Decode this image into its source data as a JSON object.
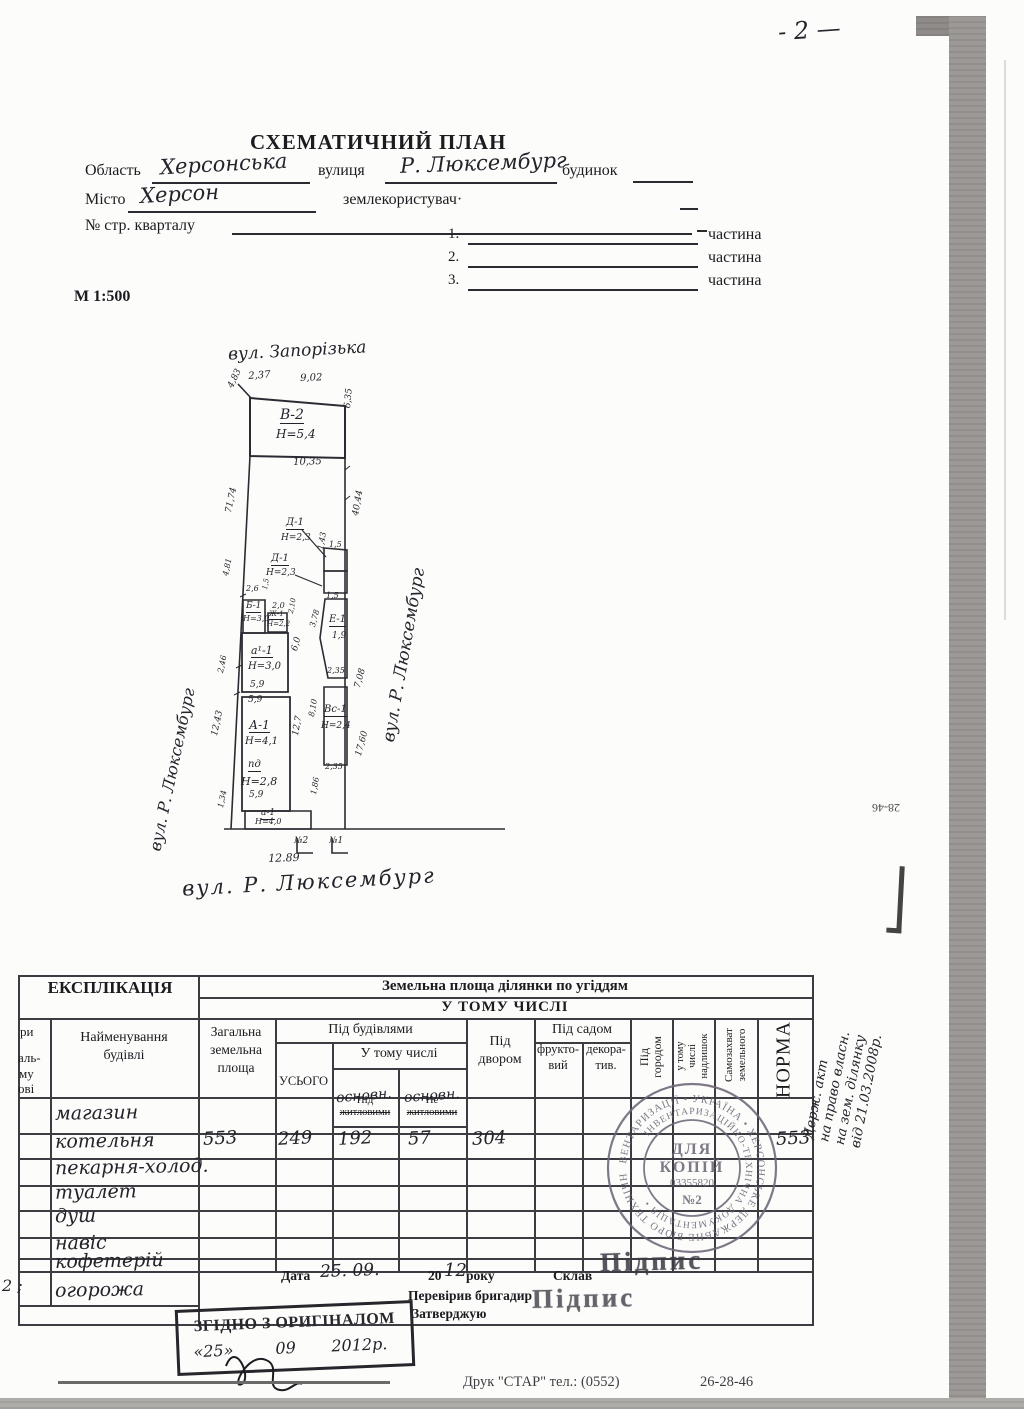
{
  "page": {
    "number": "- 2 —",
    "scale": "М 1:500",
    "footer_print": "Друк \"СТАР\" тел.: (0552)",
    "footer_phone": "26-28-46",
    "edge_note": "28-46"
  },
  "header": {
    "title": "СХЕМАТИЧНИЙ ПЛАН"
  },
  "form": {
    "oblast_label": "Область",
    "oblast_value": "Херсонська",
    "street_label": "вулиця",
    "street_value": "Р. Люксембург",
    "budynok_label": "будинок",
    "misto_label": "Місто",
    "misto_value": "Херсон",
    "landuser_label": "землекористувач·",
    "kvartal_label": "№ стр. кварталу",
    "part1_num": "1.",
    "part2_num": "2.",
    "part3_num": "3.",
    "part_label": "частина"
  },
  "plan": {
    "street_top": "вул. Запорізька",
    "street_left": "вул. Р. Люксембург",
    "street_right": "вул. Р. Люксембург",
    "street_bottom": "вул. Р. Люксембург",
    "labels": [
      {
        "t": "2,37",
        "x": 248,
        "y": 372,
        "s": 10,
        "r": -4,
        "u": 0
      },
      {
        "t": "9,02",
        "x": 300,
        "y": 374,
        "s": 10,
        "r": -2,
        "u": 0
      },
      {
        "t": "4,83",
        "x": 227,
        "y": 386,
        "s": 9,
        "r": -65,
        "u": 0
      },
      {
        "t": "В-2",
        "x": 280,
        "y": 408,
        "s": 14,
        "r": 0,
        "u": 1
      },
      {
        "t": "Н=5,4",
        "x": 276,
        "y": 428,
        "s": 12,
        "r": 0,
        "u": 0
      },
      {
        "t": "6,35",
        "x": 344,
        "y": 408,
        "s": 9,
        "r": -85,
        "u": 0
      },
      {
        "t": "10,35",
        "x": 293,
        "y": 458,
        "s": 10,
        "r": -2,
        "u": 0
      },
      {
        "t": "71,74",
        "x": 225,
        "y": 512,
        "s": 9,
        "r": -78,
        "u": 0
      },
      {
        "t": "40,44",
        "x": 352,
        "y": 515,
        "s": 9,
        "r": -80,
        "u": 0
      },
      {
        "t": "Д-1",
        "x": 286,
        "y": 518,
        "s": 10,
        "r": 0,
        "u": 1
      },
      {
        "t": "Н=2,3",
        "x": 281,
        "y": 534,
        "s": 9,
        "r": 0,
        "u": 0
      },
      {
        "t": "1,5",
        "x": 329,
        "y": 541,
        "s": 8,
        "r": 0,
        "u": 0
      },
      {
        "t": "1,43",
        "x": 317,
        "y": 549,
        "s": 8,
        "r": -80,
        "u": 0
      },
      {
        "t": "Д-1",
        "x": 271,
        "y": 554,
        "s": 10,
        "r": 0,
        "u": 1
      },
      {
        "t": "Н=2,3",
        "x": 266,
        "y": 569,
        "s": 9,
        "r": 0,
        "u": 0
      },
      {
        "t": "1,5",
        "x": 326,
        "y": 592,
        "s": 8,
        "r": 0,
        "u": 0
      },
      {
        "t": "Е-1",
        "x": 329,
        "y": 615,
        "s": 10,
        "r": 0,
        "u": 1
      },
      {
        "t": "1,9",
        "x": 332,
        "y": 632,
        "s": 9,
        "r": 0,
        "u": 0
      },
      {
        "t": "3,78",
        "x": 309,
        "y": 626,
        "s": 8,
        "r": -75,
        "u": 0
      },
      {
        "t": "2,35",
        "x": 327,
        "y": 667,
        "s": 8,
        "r": 0,
        "u": 0
      },
      {
        "t": "7,08",
        "x": 354,
        "y": 687,
        "s": 9,
        "r": -75,
        "u": 0
      },
      {
        "t": "Вс-1",
        "x": 324,
        "y": 705,
        "s": 10,
        "r": 0,
        "u": 1
      },
      {
        "t": "Н=2,4",
        "x": 321,
        "y": 722,
        "s": 9,
        "r": 0,
        "u": 0
      },
      {
        "t": "8,10",
        "x": 308,
        "y": 716,
        "s": 8,
        "r": -80,
        "u": 0
      },
      {
        "t": "2,35",
        "x": 325,
        "y": 763,
        "s": 8,
        "r": 0,
        "u": 0
      },
      {
        "t": "17,60",
        "x": 355,
        "y": 755,
        "s": 9,
        "r": -75,
        "u": 0
      },
      {
        "t": "2,6",
        "x": 246,
        "y": 585,
        "s": 8,
        "r": 0,
        "u": 0
      },
      {
        "t": "1,5",
        "x": 262,
        "y": 589,
        "s": 7,
        "r": -80,
        "u": 0
      },
      {
        "t": "Б-1",
        "x": 246,
        "y": 602,
        "s": 9,
        "r": 0,
        "u": 1
      },
      {
        "t": "Н=3,0",
        "x": 243,
        "y": 615,
        "s": 8,
        "r": 0,
        "u": 0
      },
      {
        "t": "2,0",
        "x": 272,
        "y": 602,
        "s": 8,
        "r": 0,
        "u": 0
      },
      {
        "t": "Ж-1",
        "x": 269,
        "y": 611,
        "s": 7,
        "r": 0,
        "u": 1
      },
      {
        "t": "Н=2,2",
        "x": 267,
        "y": 621,
        "s": 7,
        "r": 0,
        "u": 0
      },
      {
        "t": "2,10",
        "x": 288,
        "y": 613,
        "s": 7,
        "r": -80,
        "u": 0
      },
      {
        "t": "а¹-1",
        "x": 251,
        "y": 645,
        "s": 11,
        "r": 0,
        "u": 1
      },
      {
        "t": "Н=3,0",
        "x": 248,
        "y": 662,
        "s": 10,
        "r": 0,
        "u": 0
      },
      {
        "t": "6,0",
        "x": 291,
        "y": 650,
        "s": 9,
        "r": -75,
        "u": 0
      },
      {
        "t": "5,9",
        "x": 250,
        "y": 681,
        "s": 9,
        "r": 0,
        "u": 0
      },
      {
        "t": "5,9",
        "x": 248,
        "y": 696,
        "s": 9,
        "r": 0,
        "u": 0
      },
      {
        "t": "4,81",
        "x": 222,
        "y": 575,
        "s": 8,
        "r": -78,
        "u": 0
      },
      {
        "t": "2,46",
        "x": 217,
        "y": 672,
        "s": 8,
        "r": -78,
        "u": 0
      },
      {
        "t": "12,43",
        "x": 211,
        "y": 735,
        "s": 9,
        "r": -78,
        "u": 0
      },
      {
        "t": "1,34",
        "x": 217,
        "y": 807,
        "s": 8,
        "r": -78,
        "u": 0
      },
      {
        "t": "А-1",
        "x": 249,
        "y": 719,
        "s": 12,
        "r": 0,
        "u": 1
      },
      {
        "t": "Н=4,1",
        "x": 245,
        "y": 737,
        "s": 10,
        "r": 0,
        "u": 0
      },
      {
        "t": "12,7",
        "x": 292,
        "y": 735,
        "s": 9,
        "r": -80,
        "u": 0
      },
      {
        "t": "пд",
        "x": 248,
        "y": 760,
        "s": 10,
        "r": 0,
        "u": 1
      },
      {
        "t": "Н=2,8",
        "x": 241,
        "y": 776,
        "s": 11,
        "r": 0,
        "u": 0
      },
      {
        "t": "5,9",
        "x": 249,
        "y": 791,
        "s": 9,
        "r": 0,
        "u": 0
      },
      {
        "t": "1,86",
        "x": 310,
        "y": 794,
        "s": 8,
        "r": -80,
        "u": 0
      },
      {
        "t": "а-1",
        "x": 261,
        "y": 809,
        "s": 9,
        "r": 0,
        "u": 1
      },
      {
        "t": "Н=4,0",
        "x": 255,
        "y": 818,
        "s": 8,
        "r": 0,
        "u": 0
      },
      {
        "t": "№2",
        "x": 294,
        "y": 837,
        "s": 9,
        "r": 0,
        "u": 0
      },
      {
        "t": "№1",
        "x": 329,
        "y": 837,
        "s": 9,
        "r": 0,
        "u": 0
      },
      {
        "t": "12.89",
        "x": 268,
        "y": 853,
        "s": 11,
        "r": -2,
        "u": 0
      }
    ]
  },
  "table": {
    "explication": "ЕКСПЛІКАЦІЯ",
    "title": "Земельна площа ділянки по угіддям",
    "subtitle": "У ТОМУ ЧИСЛІ",
    "col_letters_fragments": [
      "ри",
      "аль-",
      "му",
      "ові"
    ],
    "col_name": [
      "Найменування",
      "будівлі"
    ],
    "col_total": [
      "Загальна",
      "земельна",
      "площа"
    ],
    "col_under_buildings": "Під будівлями",
    "col_usogo": "УСЬОГО",
    "col_utc": "У тому числі",
    "col_zhy": [
      "Під",
      "житловими"
    ],
    "col_zhy_hw": "основн.",
    "col_nezhy": [
      "Не",
      "житловими"
    ],
    "col_nezhy_hw": "основн.",
    "col_dvor": [
      "Під",
      "двором"
    ],
    "col_sad": "Під садом",
    "col_frukt": [
      "фрукто-",
      "вий"
    ],
    "col_dekor": [
      "декора-",
      "тив."
    ],
    "col_gorod": [
      "Під",
      "городом"
    ],
    "col_nadl": [
      "у тому",
      "числі",
      "надлишок"
    ],
    "col_samo": [
      "Самозахват",
      "земельного"
    ],
    "col_norma": "НОРМА",
    "rows": [
      {
        "letter": "",
        "name": "магазин"
      },
      {
        "letter": "",
        "name": "котельня",
        "total": "553",
        "usogo": "249",
        "zh": "192",
        "nezh": "57",
        "dvir": "304",
        "norma": "553"
      },
      {
        "letter": "",
        "name": "пекарня-холод."
      },
      {
        "letter": "",
        "name": "туалет"
      },
      {
        "letter": "",
        "name": "душ"
      },
      {
        "letter": "",
        "name": "навіс"
      },
      {
        "letter": "",
        "name": "кофетерій"
      },
      {
        "letter": "2 ;",
        "name": "огорожа"
      }
    ]
  },
  "footer_block": {
    "data_label": "Дата",
    "date_hw": "25. 09.",
    "year_print": "20",
    "year_hw": "12",
    "year_suffix": "року",
    "sklav": "Склав",
    "pereviryv": "Перевірив бригадир",
    "zatverdzhuyu": "Затверджую",
    "pidpys": "Підпис"
  },
  "stamps": {
    "round": {
      "l1": "ДЛЯ",
      "l2": "КОПІЙ",
      "num": "03355820",
      "l3": "№2",
      "ring_outer": "ІНВЕНТАРИЗАЦІЇ • УКРАЇНА • ХЕРСОНСЬКЕ ДЕРЖАВНЕ БЮРО ТЕХНІЧНОЇ",
      "ring_inner": "ІНВЕНТАРИЗАЦІЙНО-ТЕХНІЧНА ДОКУМЕНТАЦІЯ •"
    },
    "rect": {
      "text": "ЗГІДНО З ОРИГІНАЛОМ",
      "d1": "«25»",
      "d2": "09",
      "d3": "2012р."
    }
  },
  "margin_note": {
    "l1": "Держ. акт",
    "l2": "на право власн.",
    "l3": "на зем. ділянку",
    "l4": "від 21.03.2008р."
  }
}
